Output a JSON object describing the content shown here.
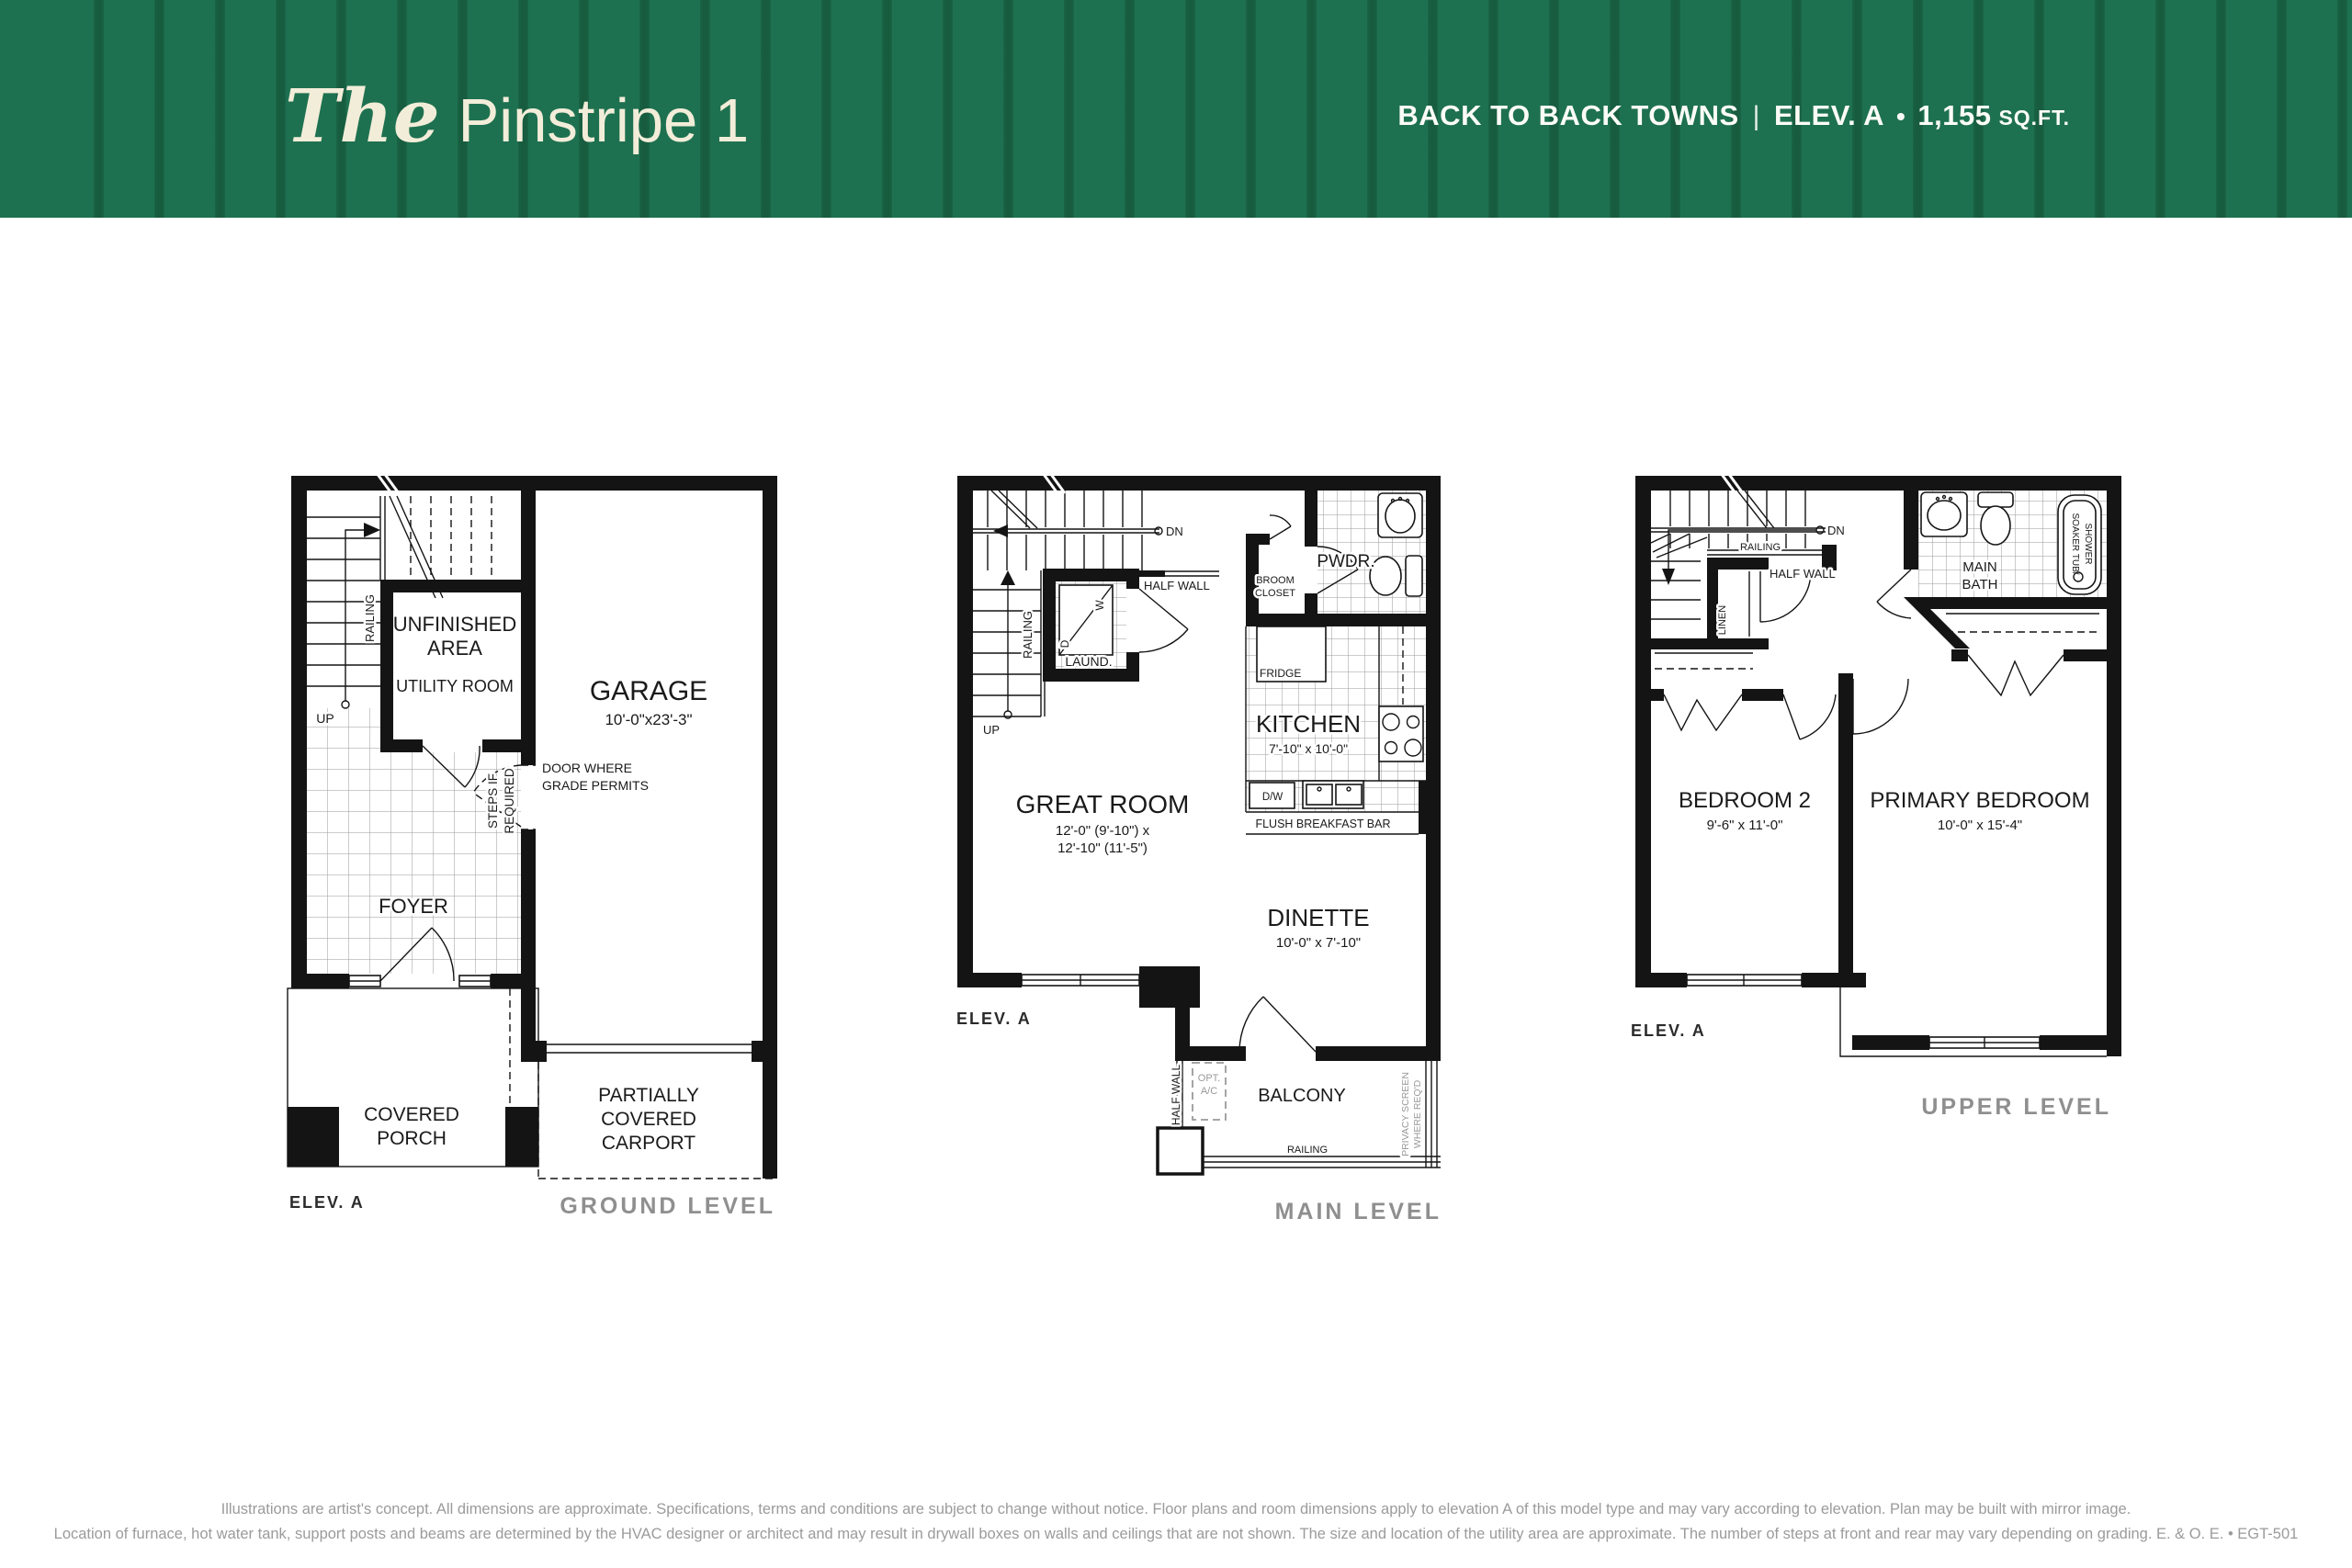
{
  "header": {
    "title_the": "The",
    "title_name": "Pinstripe 1",
    "product": "BACK TO BACK TOWNS",
    "divider": "|",
    "elevation": "ELEV. A",
    "bullet": "•",
    "sqft_value": "1,155",
    "sqft_unit": "SQ.FT.",
    "colors": {
      "banner_green": "#1E7150",
      "stripe_green": "#175C3F",
      "cream": "#F2EDD9",
      "caption_gray": "#8F8F8F"
    }
  },
  "ground": {
    "elev": "ELEV. A",
    "caption": "GROUND LEVEL",
    "labels": {
      "unfinished": [
        "UNFINISHED",
        "AREA"
      ],
      "utility": "UTILITY ROOM",
      "garage": "GARAGE",
      "garage_dim": "10'-0\"x23'-3\"",
      "door_grade": [
        "DOOR WHERE",
        "GRADE PERMITS"
      ],
      "steps": [
        "STEPS IF",
        "REQUIRED"
      ],
      "railing": "RAILING",
      "up": "UP",
      "foyer": "FOYER",
      "porch": [
        "COVERED",
        "PORCH"
      ],
      "carport": [
        "PARTIALLY",
        "COVERED",
        "CARPORT"
      ]
    }
  },
  "main": {
    "elev": "ELEV. A",
    "caption": "MAIN LEVEL",
    "labels": {
      "dn": "DN",
      "up": "UP",
      "railing": "RAILING",
      "half_wall": "HALF WALL",
      "laund": "LAUND.",
      "w": "W",
      "d": "D",
      "broom": [
        "BROOM",
        "CLOSET"
      ],
      "pwdr": "PWDR.",
      "fridge": "FRIDGE",
      "kitchen": "KITCHEN",
      "kitchen_dim": "7'-10\" x 10'-0\"",
      "dw": "D/W",
      "breakfast_bar": "FLUSH BREAKFAST BAR",
      "great_room": "GREAT ROOM",
      "great_room_dim": [
        "12'-0\" (9'-10\") x",
        "12'-10\" (11'-5\")"
      ],
      "dinette": "DINETTE",
      "dinette_dim": "10'-0\" x 7'-10\"",
      "opt_ac": [
        "OPT.",
        "A/C"
      ],
      "half_wall_v": "HALF WALL",
      "balcony": "BALCONY",
      "railing_b": "RAILING",
      "privacy": [
        "PRIVACY SCREEN",
        "WHERE REQ'D"
      ]
    }
  },
  "upper": {
    "elev": "ELEV. A",
    "caption": "UPPER LEVEL",
    "labels": {
      "dn": "DN",
      "railing": "RAILING",
      "half_wall": "HALF WALL",
      "linen": "LINEN",
      "main_bath": [
        "MAIN",
        "BATH"
      ],
      "soaker": [
        "SOAKER TUB/",
        "SHOWER"
      ],
      "bedroom2": "BEDROOM 2",
      "bedroom2_dim": "9'-6\" x 11'-0\"",
      "primary": "PRIMARY BEDROOM",
      "primary_dim": "10'-0\" x 15'-4\""
    }
  },
  "footer": {
    "line1": "Illustrations are artist's concept. All dimensions are approximate. Specifications, terms and conditions are subject to change without notice. Floor plans and room dimensions apply to elevation A of this model type and may vary according to elevation. Plan may be built with mirror image.",
    "line2": "Location of furnace, hot water tank, support posts and beams are determined by the HVAC designer or architect and may result in drywall boxes on walls and ceilings that are not shown. The size and location of the utility area are approximate. The number of steps at front and rear may vary depending on grading. E. & O. E. • EGT-501"
  }
}
